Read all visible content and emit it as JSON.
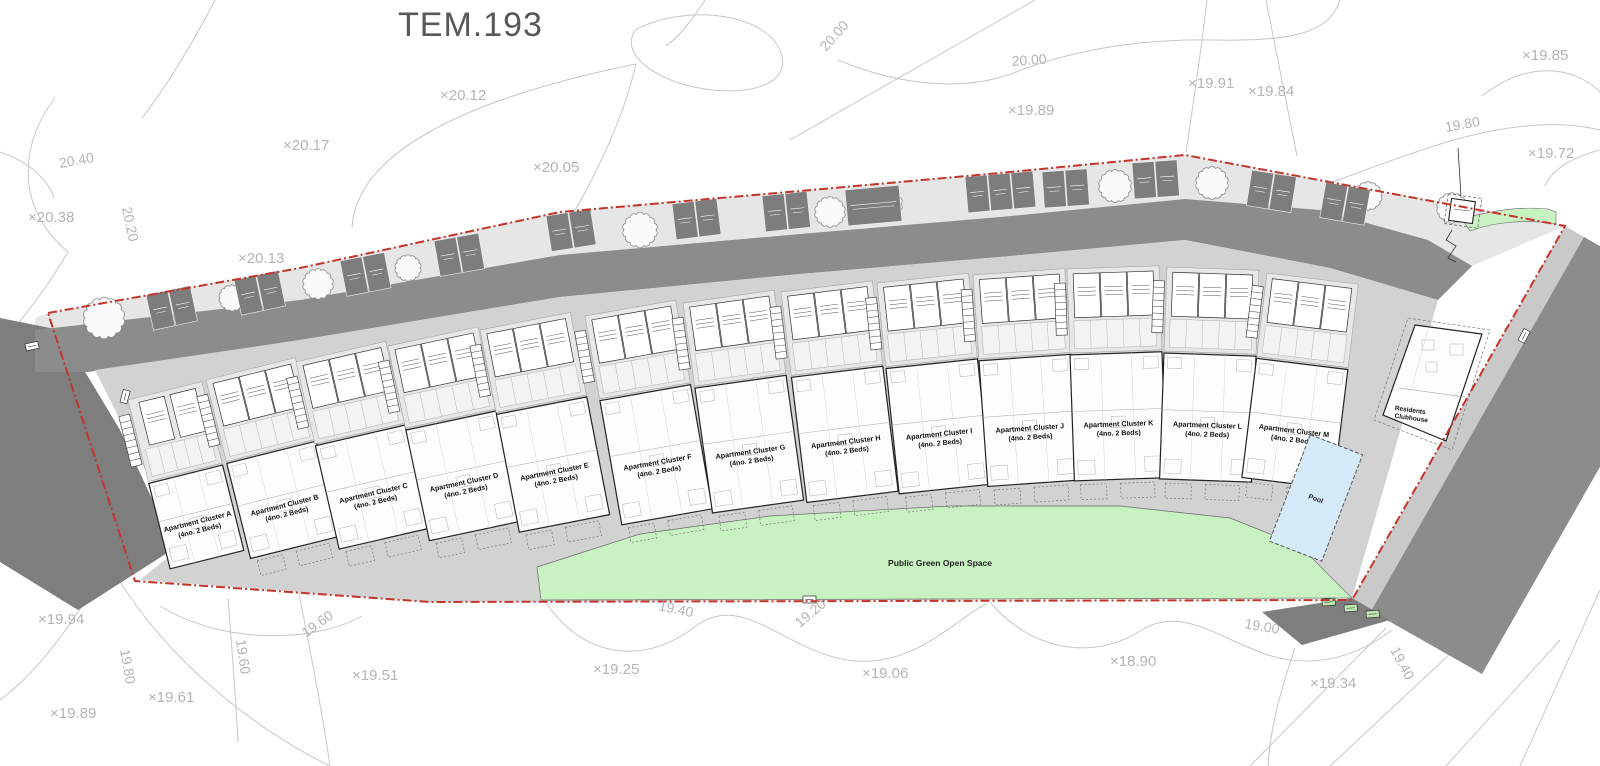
{
  "title": "TEM.193",
  "site": {
    "clusters": [
      {
        "name": "Apartment Cluster A",
        "beds": "(4no. 2 Beds)"
      },
      {
        "name": "Apartment Cluster B",
        "beds": "(4no. 2 Beds)"
      },
      {
        "name": "Apartment Cluster C",
        "beds": "(4no. 2 Beds)"
      },
      {
        "name": "Apartment Cluster D",
        "beds": "(4no. 2 Beds)"
      },
      {
        "name": "Apartment Cluster E",
        "beds": "(4no. 2 Beds)"
      },
      {
        "name": "Apartment Cluster F",
        "beds": "(4no. 2 Beds)"
      },
      {
        "name": "Apartment Cluster G",
        "beds": "(4no. 2 Beds)"
      },
      {
        "name": "Apartment Cluster H",
        "beds": "(4no. 2 Beds)"
      },
      {
        "name": "Apartment Cluster I",
        "beds": "(4no. 2 Beds)"
      },
      {
        "name": "Apartment Cluster J",
        "beds": "(4no. 2 Beds)"
      },
      {
        "name": "Apartment Cluster K",
        "beds": "(4no. 2 Beds)"
      },
      {
        "name": "Apartment Cluster L",
        "beds": "(4no. 2 Beds)"
      },
      {
        "name": "Apartment Cluster M",
        "beds": "(4no. 2 Beds)"
      }
    ],
    "clubhouse": {
      "line1": "Residents",
      "line2": "Clubhouse"
    },
    "pool_label": "Pool",
    "green_space_label": "Public Green Open Space",
    "spot_levels": [
      {
        "label": "×20.12",
        "x": 440,
        "y": 100
      },
      {
        "label": "×20.17",
        "x": 283,
        "y": 150
      },
      {
        "label": "×20.05",
        "x": 533,
        "y": 172
      },
      {
        "label": "×20.38",
        "x": 28,
        "y": 222
      },
      {
        "label": "×20.13",
        "x": 238,
        "y": 263
      },
      {
        "label": "×19.89",
        "x": 1008,
        "y": 115
      },
      {
        "label": "×19.91",
        "x": 1188,
        "y": 88
      },
      {
        "label": "×19.84",
        "x": 1248,
        "y": 96
      },
      {
        "label": "×19.85",
        "x": 1522,
        "y": 60
      },
      {
        "label": "×19.72",
        "x": 1528,
        "y": 158
      },
      {
        "label": "×19.94",
        "x": 38,
        "y": 624
      },
      {
        "label": "×19.89",
        "x": 50,
        "y": 718
      },
      {
        "label": "×19.61",
        "x": 148,
        "y": 702
      },
      {
        "label": "×19.51",
        "x": 352,
        "y": 680
      },
      {
        "label": "×19.25",
        "x": 593,
        "y": 674
      },
      {
        "label": "×19.06",
        "x": 862,
        "y": 678
      },
      {
        "label": "×18.90",
        "x": 1110,
        "y": 666
      },
      {
        "label": "×19.34",
        "x": 1310,
        "y": 688
      }
    ],
    "contour_labels": [
      {
        "label": "20.40",
        "x": 60,
        "y": 168,
        "rot": -10
      },
      {
        "label": "20.20",
        "x": 122,
        "y": 208,
        "rot": 78
      },
      {
        "label": "20.00",
        "x": 826,
        "y": 52,
        "rot": -48
      },
      {
        "label": "20.00",
        "x": 1012,
        "y": 66,
        "rot": -4
      },
      {
        "label": "19.80",
        "x": 1446,
        "y": 132,
        "rot": -10
      },
      {
        "label": "19.80",
        "x": 120,
        "y": 650,
        "rot": 80
      },
      {
        "label": "19.60",
        "x": 236,
        "y": 640,
        "rot": 82
      },
      {
        "label": "19.60",
        "x": 306,
        "y": 638,
        "rot": -36
      },
      {
        "label": "19.40",
        "x": 658,
        "y": 610,
        "rot": 12
      },
      {
        "label": "19.20",
        "x": 800,
        "y": 628,
        "rot": -40
      },
      {
        "label": "19.00",
        "x": 1244,
        "y": 628,
        "rot": 10
      },
      {
        "label": "19.40",
        "x": 1390,
        "y": 650,
        "rot": 62
      }
    ],
    "colors": {
      "boundary_red": "#c5342b",
      "road": "#8c8c8c",
      "road_dark": "#7e7e7e",
      "verge": "#e6e6e6",
      "right_verge": "#c9c9c9",
      "platform": "#d2d2d2",
      "green": "#c9f2c2",
      "pool": "#d6ebfa",
      "parking_bay": "#7d7d7d",
      "contour_gray": "#c7c7c7",
      "annotation_gray": "#b4b4b4",
      "title_gray": "#585858"
    }
  }
}
